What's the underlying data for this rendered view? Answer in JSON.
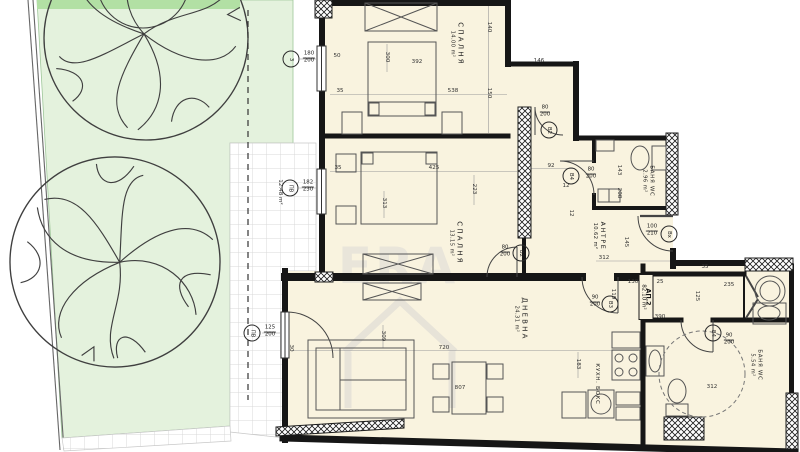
{
  "watermark": {
    "brand": "ERA"
  },
  "apartment": {
    "name": "АП.2",
    "area": "82.10 m²",
    "x": 646,
    "y": 297
  },
  "colors": {
    "floor": "#f9f3df",
    "garden": "#e4f2dd",
    "garden_strip": "#b2e0a4",
    "wall": "#161616",
    "tile_line": "#d9d9d9"
  },
  "rooms": [
    {
      "id": "bedroom-1",
      "label": "СПАЛНЯ",
      "area": "14.00 m²",
      "x": 457,
      "y": 44,
      "rot": 90,
      "size": "lg"
    },
    {
      "id": "bedroom-2",
      "label": "СПАЛНЯ",
      "area": "13.15 m²",
      "x": 456,
      "y": 243,
      "rot": 90,
      "size": "lg"
    },
    {
      "id": "hallway",
      "label": "АНТРЕ",
      "area": "10.62 m²",
      "x": 599,
      "y": 236,
      "rot": 90,
      "size": "md"
    },
    {
      "id": "bathroom-1",
      "label": "БАНЯ WC",
      "area": "2.96 m²",
      "x": 648,
      "y": 181,
      "rot": 90,
      "size": "sm"
    },
    {
      "id": "living-room",
      "label": "ДНЕВНА",
      "area": "24.31 m²",
      "x": 521,
      "y": 319,
      "rot": 90,
      "size": "lg"
    },
    {
      "id": "kitchen-box",
      "label": "КУХН. БОКС",
      "area": "",
      "x": 597,
      "y": 384,
      "rot": 90,
      "size": "sm"
    },
    {
      "id": "bathroom-2",
      "label": "БАНЯ WC",
      "area": "5.54 m²",
      "x": 756,
      "y": 365,
      "rot": 90,
      "size": "sm"
    }
  ],
  "dimensions": [
    {
      "text": "140",
      "x": 489,
      "y": 27,
      "rot": 90
    },
    {
      "text": "146",
      "x": 539,
      "y": 61,
      "rot": 0
    },
    {
      "text": "150",
      "x": 489,
      "y": 93,
      "rot": 90
    },
    {
      "text": "50",
      "x": 337,
      "y": 56,
      "rot": 0
    },
    {
      "text": "300",
      "x": 387,
      "y": 57,
      "rot": 90
    },
    {
      "text": "392",
      "x": 417,
      "y": 62,
      "rot": 0
    },
    {
      "text": "35",
      "x": 340,
      "y": 91,
      "rot": 0
    },
    {
      "text": "538",
      "x": 453,
      "y": 91,
      "rot": 0
    },
    {
      "text": "92",
      "x": 551,
      "y": 166,
      "rot": 0
    },
    {
      "text": "12",
      "x": 566,
      "y": 186,
      "rot": 0
    },
    {
      "text": "143",
      "x": 619,
      "y": 170,
      "rot": 90
    },
    {
      "text": "208",
      "x": 619,
      "y": 193,
      "rot": 90
    },
    {
      "text": "35",
      "x": 338,
      "y": 168,
      "rot": 0
    },
    {
      "text": "425",
      "x": 434,
      "y": 168,
      "rot": 0
    },
    {
      "text": "223",
      "x": 474,
      "y": 189,
      "rot": 90
    },
    {
      "text": "313",
      "x": 384,
      "y": 203,
      "rot": 90
    },
    {
      "text": "12.48 m²",
      "x": 280,
      "y": 192,
      "rot": 90
    },
    {
      "text": "145",
      "x": 626,
      "y": 242,
      "rot": 90
    },
    {
      "text": "312",
      "x": 604,
      "y": 258,
      "rot": 0
    },
    {
      "text": "12",
      "x": 571,
      "y": 213,
      "rot": 90
    },
    {
      "text": "119",
      "x": 613,
      "y": 294,
      "rot": 90
    },
    {
      "text": "130",
      "x": 633,
      "y": 282,
      "rot": 0
    },
    {
      "text": "25",
      "x": 660,
      "y": 282,
      "rot": 0
    },
    {
      "text": "35",
      "x": 705,
      "y": 267,
      "rot": 0
    },
    {
      "text": "235",
      "x": 729,
      "y": 285,
      "rot": 0
    },
    {
      "text": "125",
      "x": 697,
      "y": 296,
      "rot": 90
    },
    {
      "text": "390",
      "x": 660,
      "y": 317,
      "rot": 0
    },
    {
      "text": "309",
      "x": 383,
      "y": 336,
      "rot": 90
    },
    {
      "text": "30",
      "x": 291,
      "y": 348,
      "rot": 90
    },
    {
      "text": "720",
      "x": 444,
      "y": 348,
      "rot": 0
    },
    {
      "text": "807",
      "x": 460,
      "y": 388,
      "rot": 0
    },
    {
      "text": "183",
      "x": 578,
      "y": 364,
      "rot": 90
    },
    {
      "text": "312",
      "x": 712,
      "y": 387,
      "rot": 0
    }
  ],
  "markers": [
    {
      "id": "window-3",
      "code": "3",
      "frac_top": "180",
      "frac_bot": "200",
      "cx": 291,
      "cy": 59,
      "fx": 309,
      "fy": 58
    },
    {
      "id": "window-pv1",
      "code": "ПВ",
      "frac_top": "182",
      "frac_bot": "230",
      "cx": 290,
      "cy": 188,
      "fx": 308,
      "fy": 187
    },
    {
      "id": "door-pv2",
      "code": "ПВ",
      "frac_top": "125",
      "frac_bot": "200",
      "cx": 252,
      "cy": 333,
      "fx": 270,
      "fy": 332
    },
    {
      "id": "door-b2-bedroom1",
      "code": "В2",
      "frac_top": "80",
      "frac_bot": "200",
      "cx": 549,
      "cy": 130,
      "fx": 545,
      "fy": 112
    },
    {
      "id": "door-b2-bedroom2",
      "code": "В2",
      "frac_top": "80",
      "frac_bot": "200",
      "cx": 521,
      "cy": 253,
      "fx": 505,
      "fy": 252
    },
    {
      "id": "door-b4-bath1",
      "code": "В4",
      "frac_top": "80",
      "frac_bot": "200",
      "cx": 571,
      "cy": 176,
      "fx": 591,
      "fy": 174
    },
    {
      "id": "door-bx-entrance",
      "code": "Вх",
      "frac_top": "100",
      "frac_bot": "210",
      "cx": 669,
      "cy": 234,
      "fx": 652,
      "fy": 231
    },
    {
      "id": "door-b3-living",
      "code": "В3",
      "frac_top": "90",
      "frac_bot": "200",
      "cx": 610,
      "cy": 304,
      "fx": 595,
      "fy": 302
    },
    {
      "id": "door-b4-bath2",
      "code": "В4",
      "frac_top": "90",
      "frac_bot": "200",
      "cx": 713,
      "cy": 333,
      "fx": 729,
      "fy": 340
    }
  ]
}
